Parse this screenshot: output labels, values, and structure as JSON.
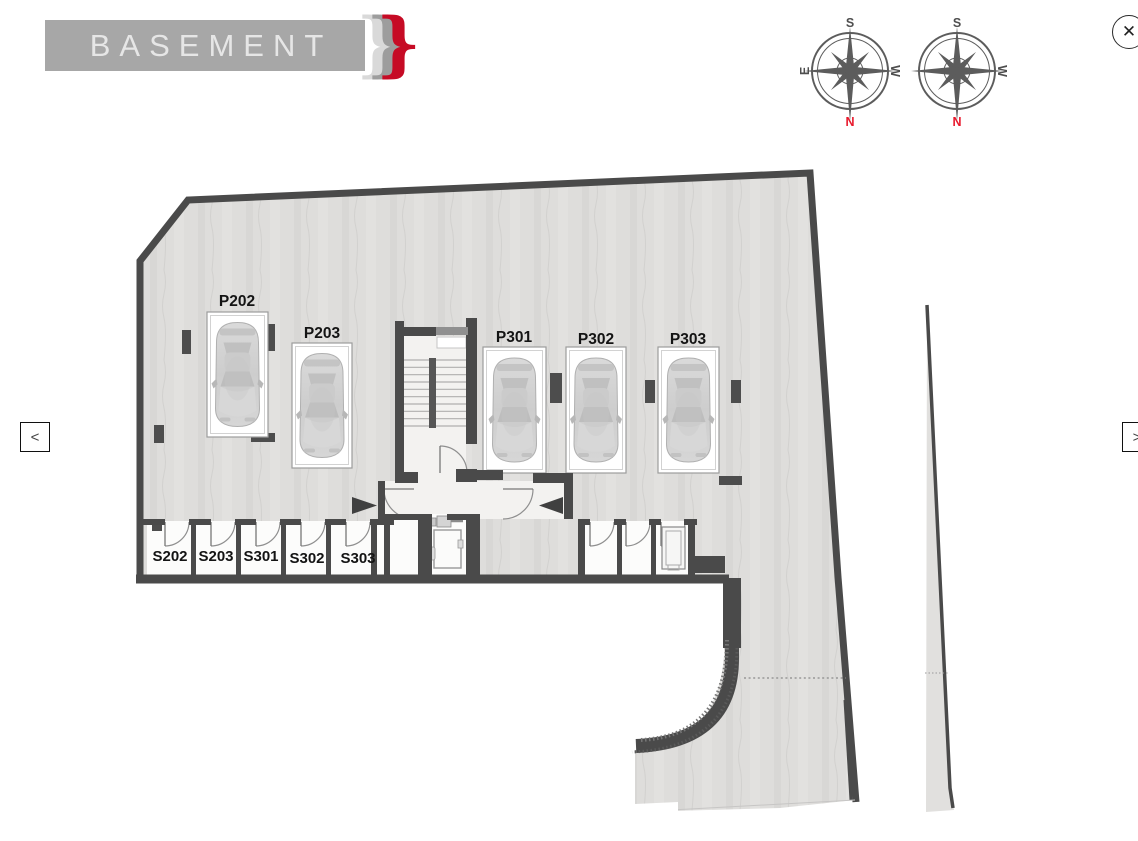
{
  "header": {
    "title": "BASEMENT"
  },
  "logo": {
    "brace": "}"
  },
  "controls": {
    "prev_label": "<",
    "next_label": ">",
    "close_label": "✕"
  },
  "compasses": [
    {
      "top": "S",
      "left": "E",
      "right": "W",
      "bottom": "N"
    },
    {
      "top": "S",
      "right": "W",
      "bottom": "N"
    }
  ],
  "plan": {
    "floor_name": "BASEMENT",
    "parking_spots": [
      {
        "label": "P202"
      },
      {
        "label": "P203"
      },
      {
        "label": "P301"
      },
      {
        "label": "P302"
      },
      {
        "label": "P303"
      }
    ],
    "storage_rooms": [
      {
        "label": "S202"
      },
      {
        "label": "S203"
      },
      {
        "label": "S301"
      },
      {
        "label": "S302"
      },
      {
        "label": "S303"
      }
    ]
  },
  "colors": {
    "wall": "#4a4a4a",
    "floor": "#dedddb",
    "corridor": "#f3f2f0",
    "banner_bg": "#a7a7a7",
    "banner_text": "#e6e6e6",
    "accent_red": "#c60b25",
    "compass_north": "#e8192c"
  }
}
